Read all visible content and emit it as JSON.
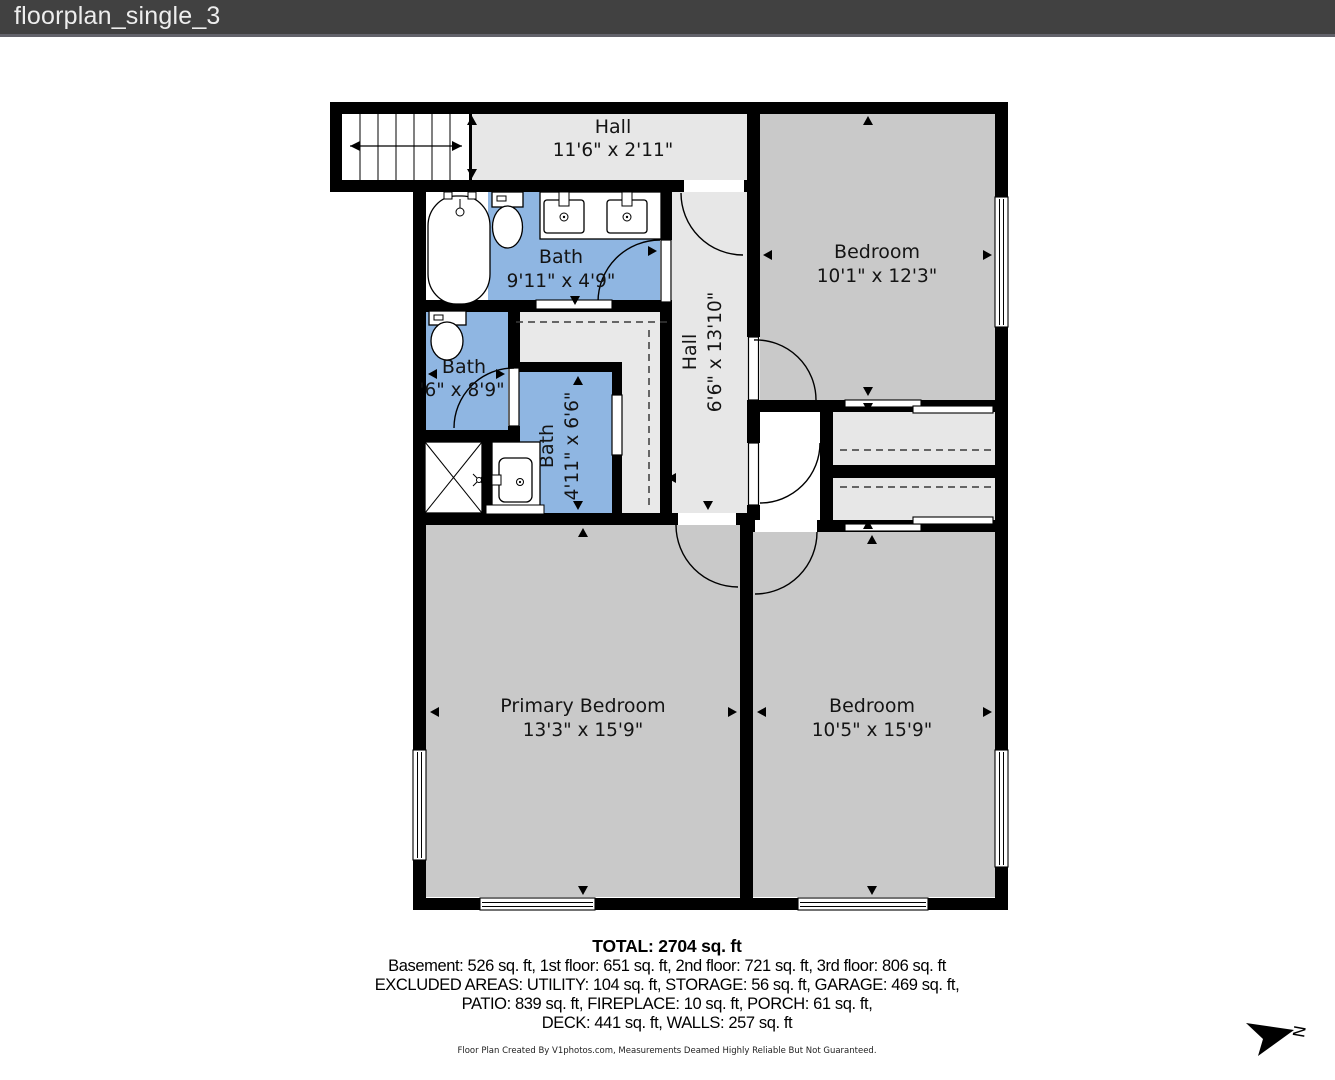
{
  "titlebar": {
    "title": "floorplan_single_3"
  },
  "rooms": {
    "hall_top": {
      "name": "Hall",
      "dims": "11'6\" x 2'11\""
    },
    "bath_top": {
      "name": "Bath",
      "dims": "9'11\" x 4'9\""
    },
    "bedroom_top": {
      "name": "Bedroom",
      "dims": "10'1\" x 12'3\""
    },
    "bath_left": {
      "name": "Bath",
      "dims": "'6\" x 8'9\""
    },
    "bath_mid": {
      "name": "Bath",
      "dims": "4'11\" x 6'6\""
    },
    "hall_vertical": {
      "name": "Hall",
      "dims": "6'6\" x 13'10\""
    },
    "primary_bedroom": {
      "name": "Primary Bedroom",
      "dims": "13'3\" x 15'9\""
    },
    "bedroom_right": {
      "name": "Bedroom",
      "dims": "10'5\" x 15'9\""
    }
  },
  "summary": {
    "total": "TOTAL: 2704 sq. ft",
    "floors": "Basement: 526 sq. ft, 1st floor: 651 sq. ft, 2nd floor: 721 sq. ft, 3rd floor: 806 sq. ft",
    "excluded1": "EXCLUDED AREAS: UTILITY: 104 sq. ft, STORAGE: 56 sq. ft, GARAGE: 469 sq. ft,",
    "excluded2": "PATIO: 839 sq. ft, FIREPLACE: 10 sq. ft, PORCH: 61 sq. ft,",
    "excluded3": "DECK: 441 sq. ft, WALLS: 257 sq. ft"
  },
  "footer": {
    "disclaimer": "Floor Plan Created By V1photos.com, Measurements Deamed Highly Reliable But Not Guaranteed."
  },
  "compass": {
    "label": "N"
  },
  "colors": {
    "wall": "#000000",
    "bedroom_fill": "#c9c9c9",
    "hall_fill": "#e7e7e7",
    "closet_fill": "#e9e9e9",
    "bath_fill": "#8fb6e2",
    "titlebar_bg": "#414141",
    "titlebar_text": "#ededed"
  }
}
